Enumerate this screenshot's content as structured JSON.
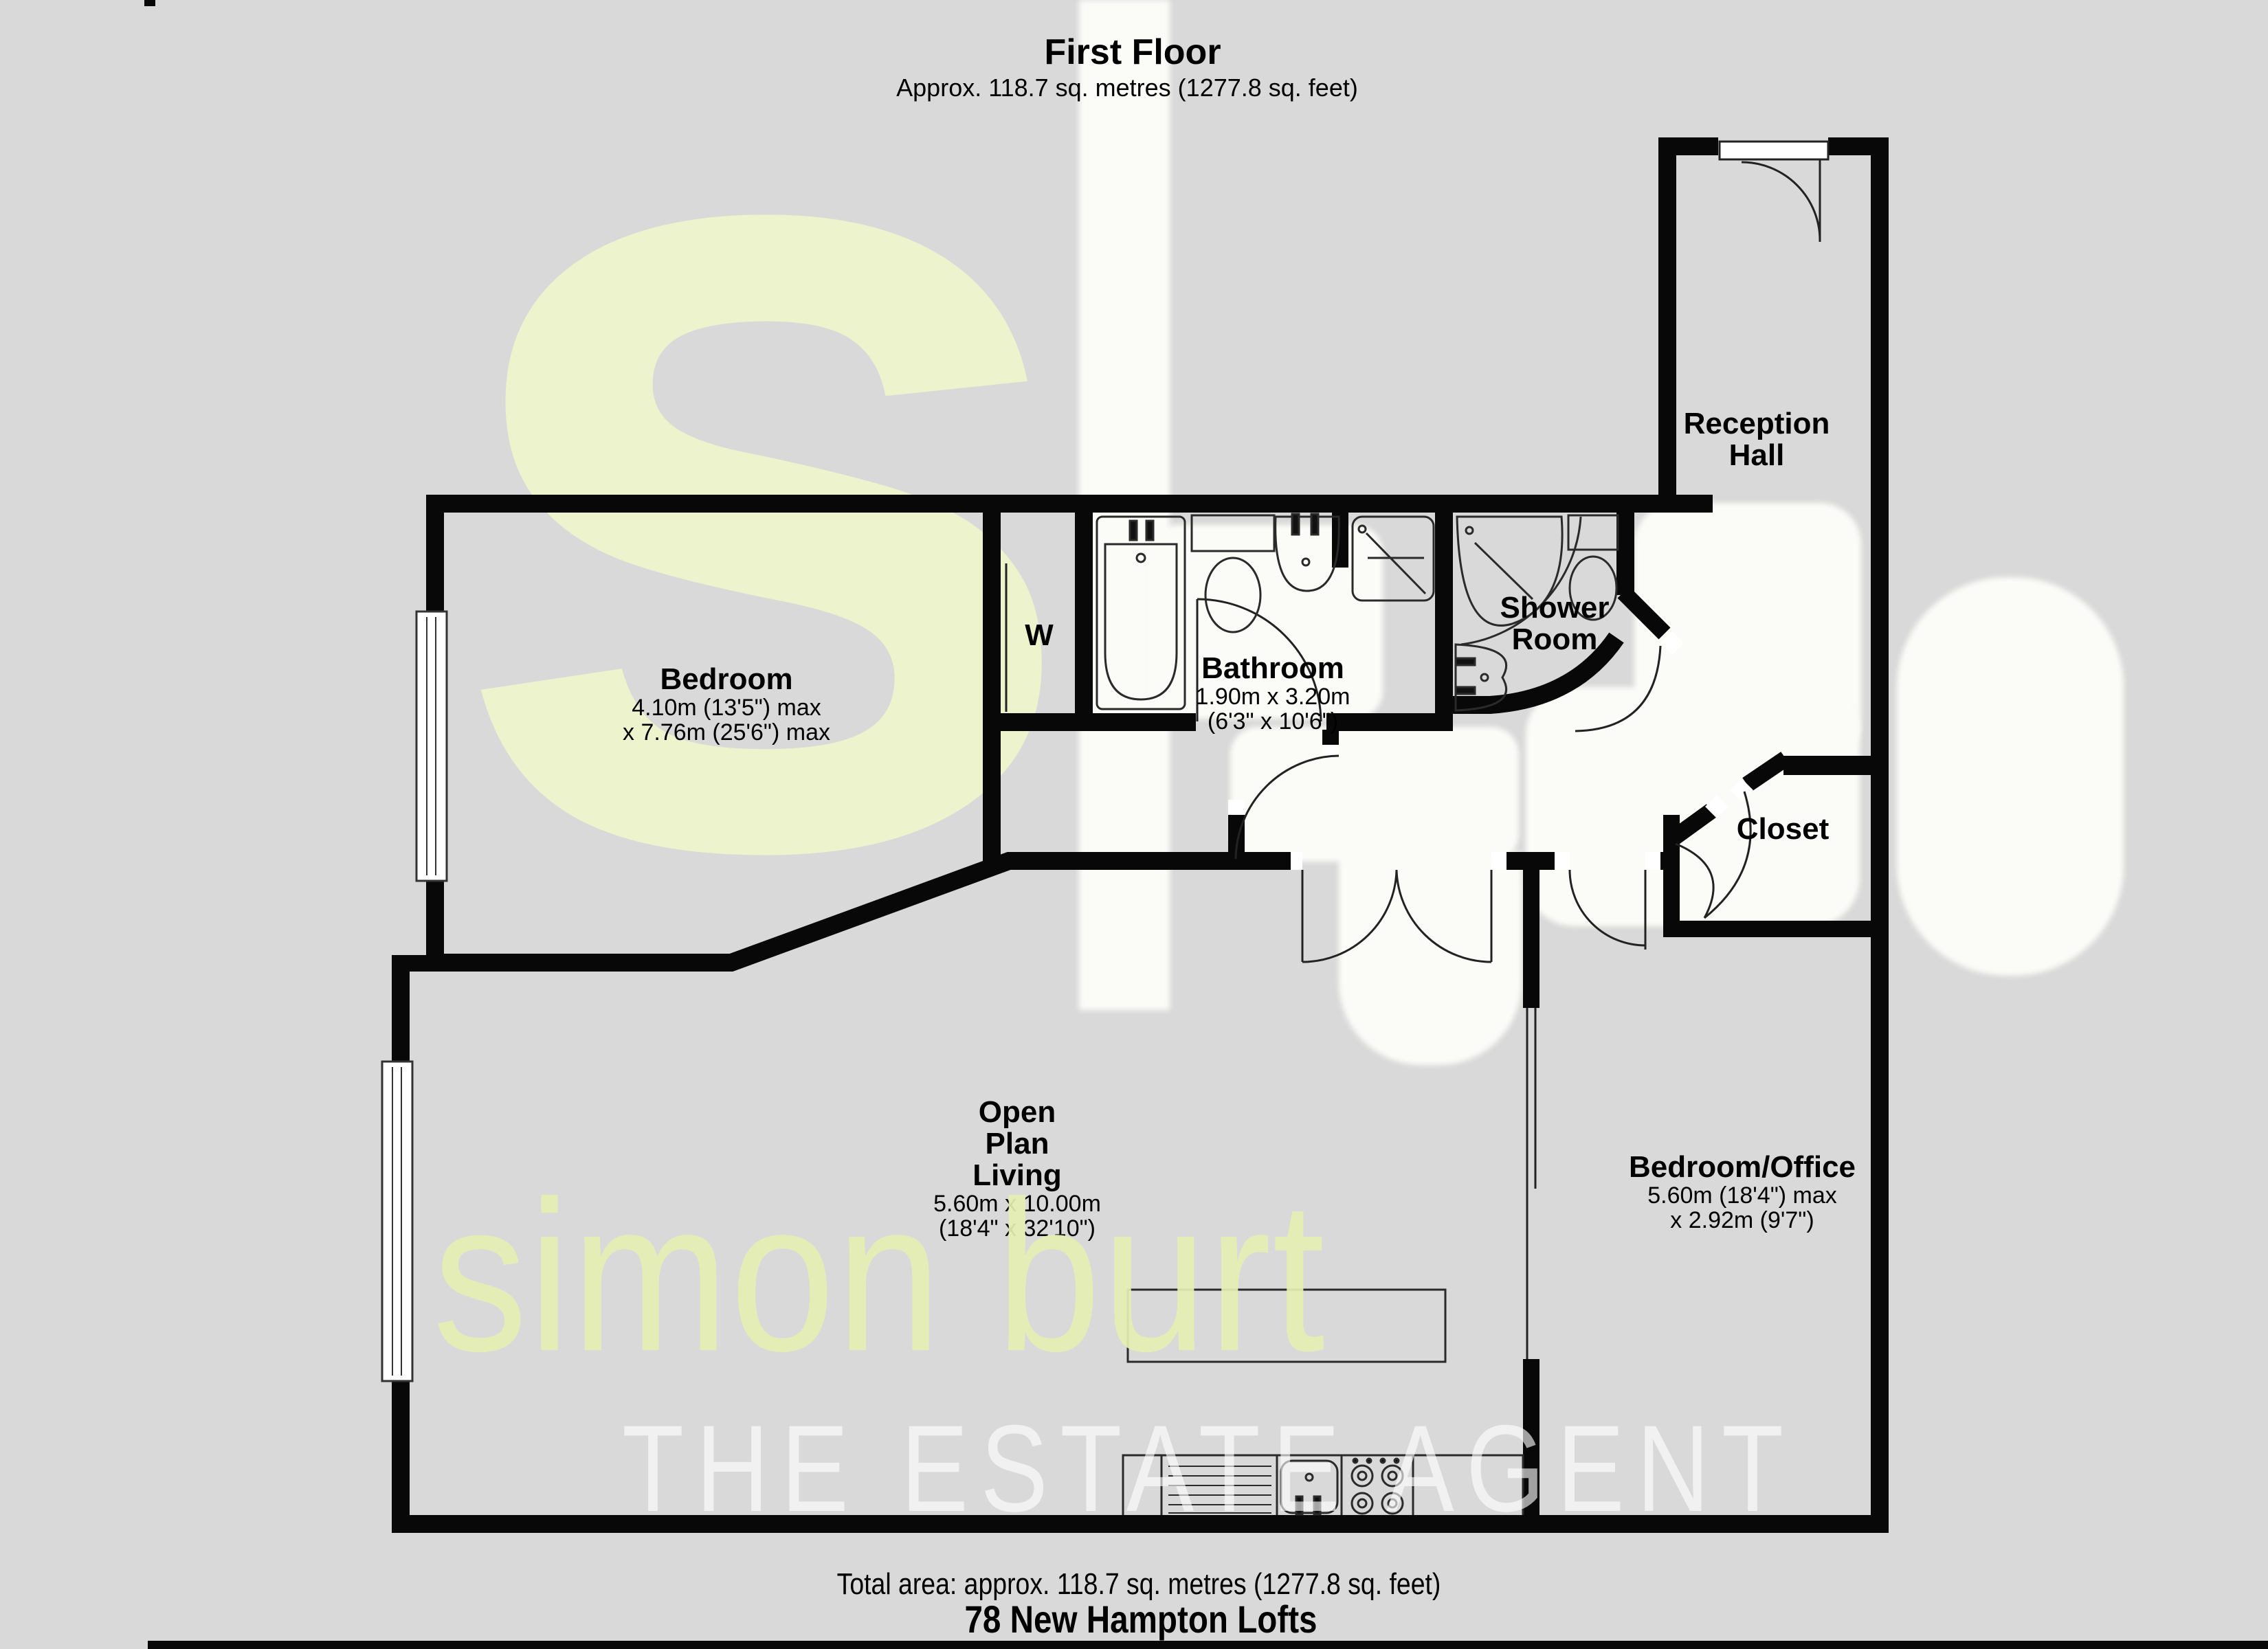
{
  "header": {
    "title": "First Floor",
    "subtitle": "Approx. 118.7 sq. metres (1277.8 sq. feet)"
  },
  "rooms": {
    "bedroom": {
      "name": "Bedroom",
      "dim1": "4.10m (13'5\") max",
      "dim2": "x 7.76m (25'6\") max"
    },
    "wardrobe": {
      "name": "W"
    },
    "bathroom": {
      "name": "Bathroom",
      "dim1": "1.90m x 3.20m",
      "dim2": "(6'3\" x 10'6\")"
    },
    "shower_room": {
      "line1": "Shower",
      "line2": "Room"
    },
    "reception_hall": {
      "line1": "Reception",
      "line2": "Hall"
    },
    "closet": {
      "name": "Closet"
    },
    "open_plan_living": {
      "line1": "Open",
      "line2": "Plan",
      "line3": "Living",
      "dim1": "5.60m x 10.00m",
      "dim2": "(18'4\" x 32'10\")"
    },
    "bedroom_office": {
      "name": "Bedroom/Office",
      "dim1": "5.60m (18'4\") max",
      "dim2": "x 2.92m (9'7\")"
    }
  },
  "footer": {
    "total": "Total area: approx. 118.7 sq. metres (1277.8 sq. feet)",
    "address": "78 New Hampton Lofts"
  },
  "watermark": {
    "logo_s": "s",
    "brand": "simon burt",
    "tagline": "THE ESTATE AGENT",
    "green_hex": "#edf3cd",
    "white_hex": "#fbfbf8",
    "background_hex": "#d9d9d9",
    "wall_hex": "#080808"
  }
}
